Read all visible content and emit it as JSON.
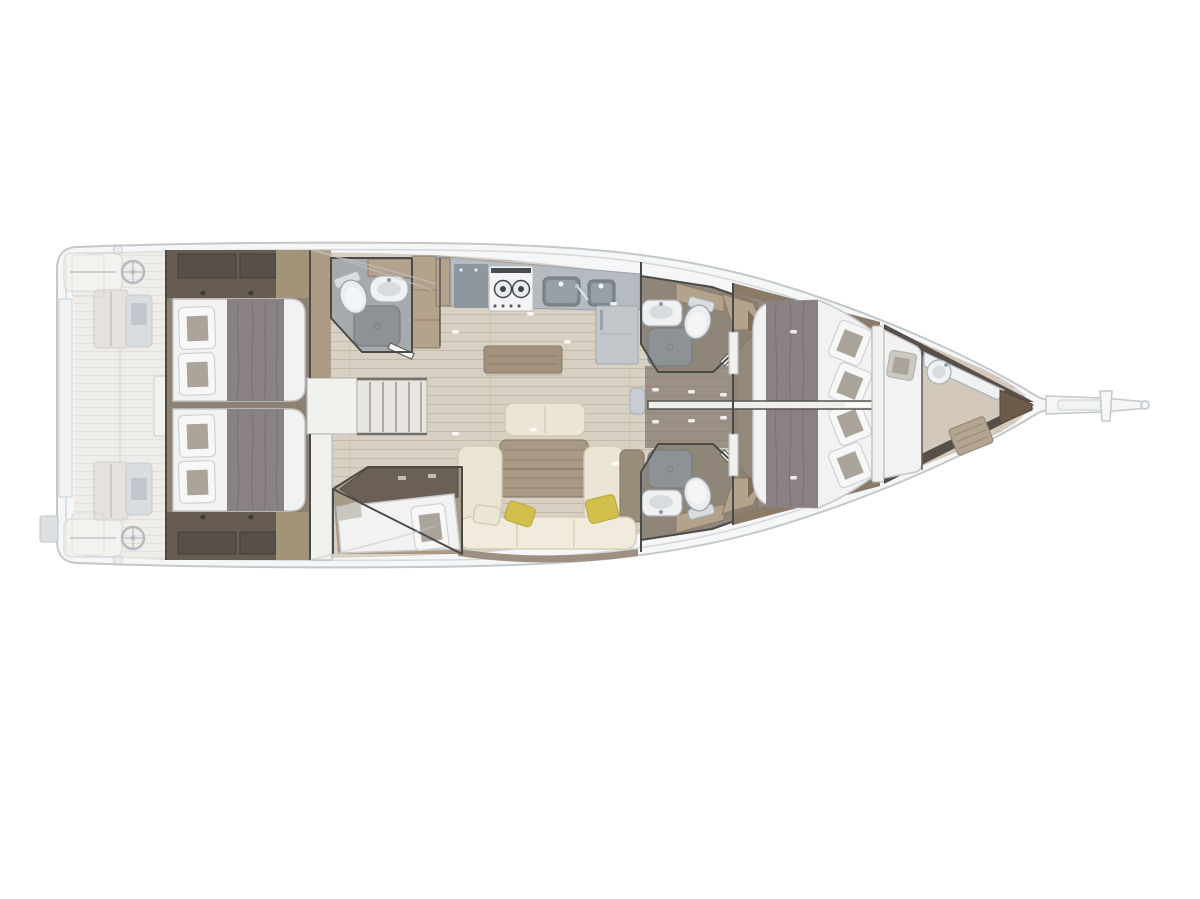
{
  "page": {
    "description": "Overhead interior layout plan of a sailing yacht, bow pointing right, shown on a white background"
  },
  "colors": {
    "background": "#ffffff",
    "hull_outline": "#c3c8cb",
    "hull_fill": "#f5f6f7",
    "deck_line": "#d4d8da",
    "cockpit_floor": "#ece8e0",
    "bench": "#f2f0ea",
    "bench_stroke": "#cfd2d4",
    "ghost_wood": "#dbd5cb",
    "console": "#c8cdd1",
    "steel": "#8f979e",
    "interior_floor": "#d8d0c2",
    "cabin_floor": "#8d8172",
    "corridor_floor": "#9a9085",
    "berth_floor": "#a99a86",
    "bow_floor": "#d2c9bb",
    "walnut": "#665c51",
    "walnut_dark": "#57504a",
    "wood_mid": "#a39378",
    "wood_tan": "#b3a28c",
    "wood_dark": "#6b6056",
    "wall": "#4a4a47",
    "bed_white": "#f2f2f3",
    "bed_stroke": "#c7c7ca",
    "duvet": "#8a8185",
    "duvet_line": "#6e656a",
    "pillow_inset": "#aaa49b",
    "sofa_cream": "#ece5d6",
    "sofa_seat": "#f0ebdd",
    "sofa_stroke": "#cfc8b6",
    "sofa_wood": "#9a8c7a",
    "table_wood": "#a89a86",
    "sideboard_wood": "#a2927d",
    "cushion_yellow": "#d3c04c",
    "cushion_yellow_stroke": "#b7a53b",
    "counter": "#b5bbc0",
    "counter_dark": "#8f979e",
    "sink_dark": "#7e8790",
    "sink_inner": "#98a0a7",
    "fridge": "#c2c7cb",
    "fixture": "#eff1f2",
    "fixture_stroke": "#aab0b5",
    "fixture_inner": "#d8dcdf",
    "shower": "#8d9296",
    "shower_stroke": "#787d81",
    "head_floor": "#a6aaad",
    "head_floor_brown": "#8f8579",
    "teak": "#b3a58f",
    "bow_seat": "#6b5b49",
    "dark_trim": "#57504a"
  },
  "vessel": {
    "view": "top-down interior floor plan",
    "bow_direction": "right",
    "areas": [
      {
        "id": "swim-platform",
        "features": [
          "transom lockers",
          "liferaft locker"
        ]
      },
      {
        "id": "cockpit",
        "features": [
          "twin helm wheels",
          "helm consoles",
          "two cockpit tables",
          "stern benches",
          "teak floor"
        ]
      },
      {
        "id": "companionway",
        "features": [
          "entry landing",
          "stair treads",
          "handrails"
        ]
      },
      {
        "id": "aft-cabin-port",
        "features": [
          "double bed",
          "grey duvet",
          "two pillows",
          "wardrobe",
          "reading lights"
        ]
      },
      {
        "id": "aft-cabin-starboard",
        "features": [
          "double bed",
          "grey duvet",
          "two pillows",
          "wardrobe",
          "reading lights"
        ]
      },
      {
        "id": "aft-head",
        "features": [
          "toilet",
          "washbasin",
          "shower tray"
        ]
      },
      {
        "id": "galley",
        "features": [
          "two-burner stove",
          "double sink",
          "worktop",
          "refrigerator",
          "sideboard"
        ]
      },
      {
        "id": "saloon",
        "features": [
          "U-shaped sofa",
          "dining table",
          "forward bench seat",
          "yellow cushions",
          "mast post"
        ]
      },
      {
        "id": "single-berth-cabin",
        "features": [
          "single berth",
          "overhead locker",
          "pillow"
        ]
      },
      {
        "id": "forward-head-port",
        "features": [
          "toilet",
          "washbasin",
          "shower tray",
          "wardrobe"
        ]
      },
      {
        "id": "forward-head-starboard",
        "features": [
          "toilet",
          "washbasin",
          "shower tray",
          "wardrobe"
        ]
      },
      {
        "id": "forward-cabin-port",
        "features": [
          "double bed",
          "grey duvet",
          "two pillows",
          "wardrobe"
        ]
      },
      {
        "id": "forward-cabin-starboard",
        "features": [
          "double bed",
          "grey duvet",
          "two pillows",
          "wardrobe"
        ]
      },
      {
        "id": "bow-cabin",
        "features": [
          "crew berth",
          "round washbasin",
          "teak shower grate",
          "corner seat"
        ]
      },
      {
        "id": "bowsprit",
        "features": [
          "anchor roller",
          "bow fitting"
        ]
      }
    ],
    "counts": {
      "helm_wheels": 2,
      "double_beds": 4,
      "single_berths": 2,
      "heads": 4,
      "showers": 4,
      "sinks_galley": 2,
      "stove_burners": 2
    }
  }
}
